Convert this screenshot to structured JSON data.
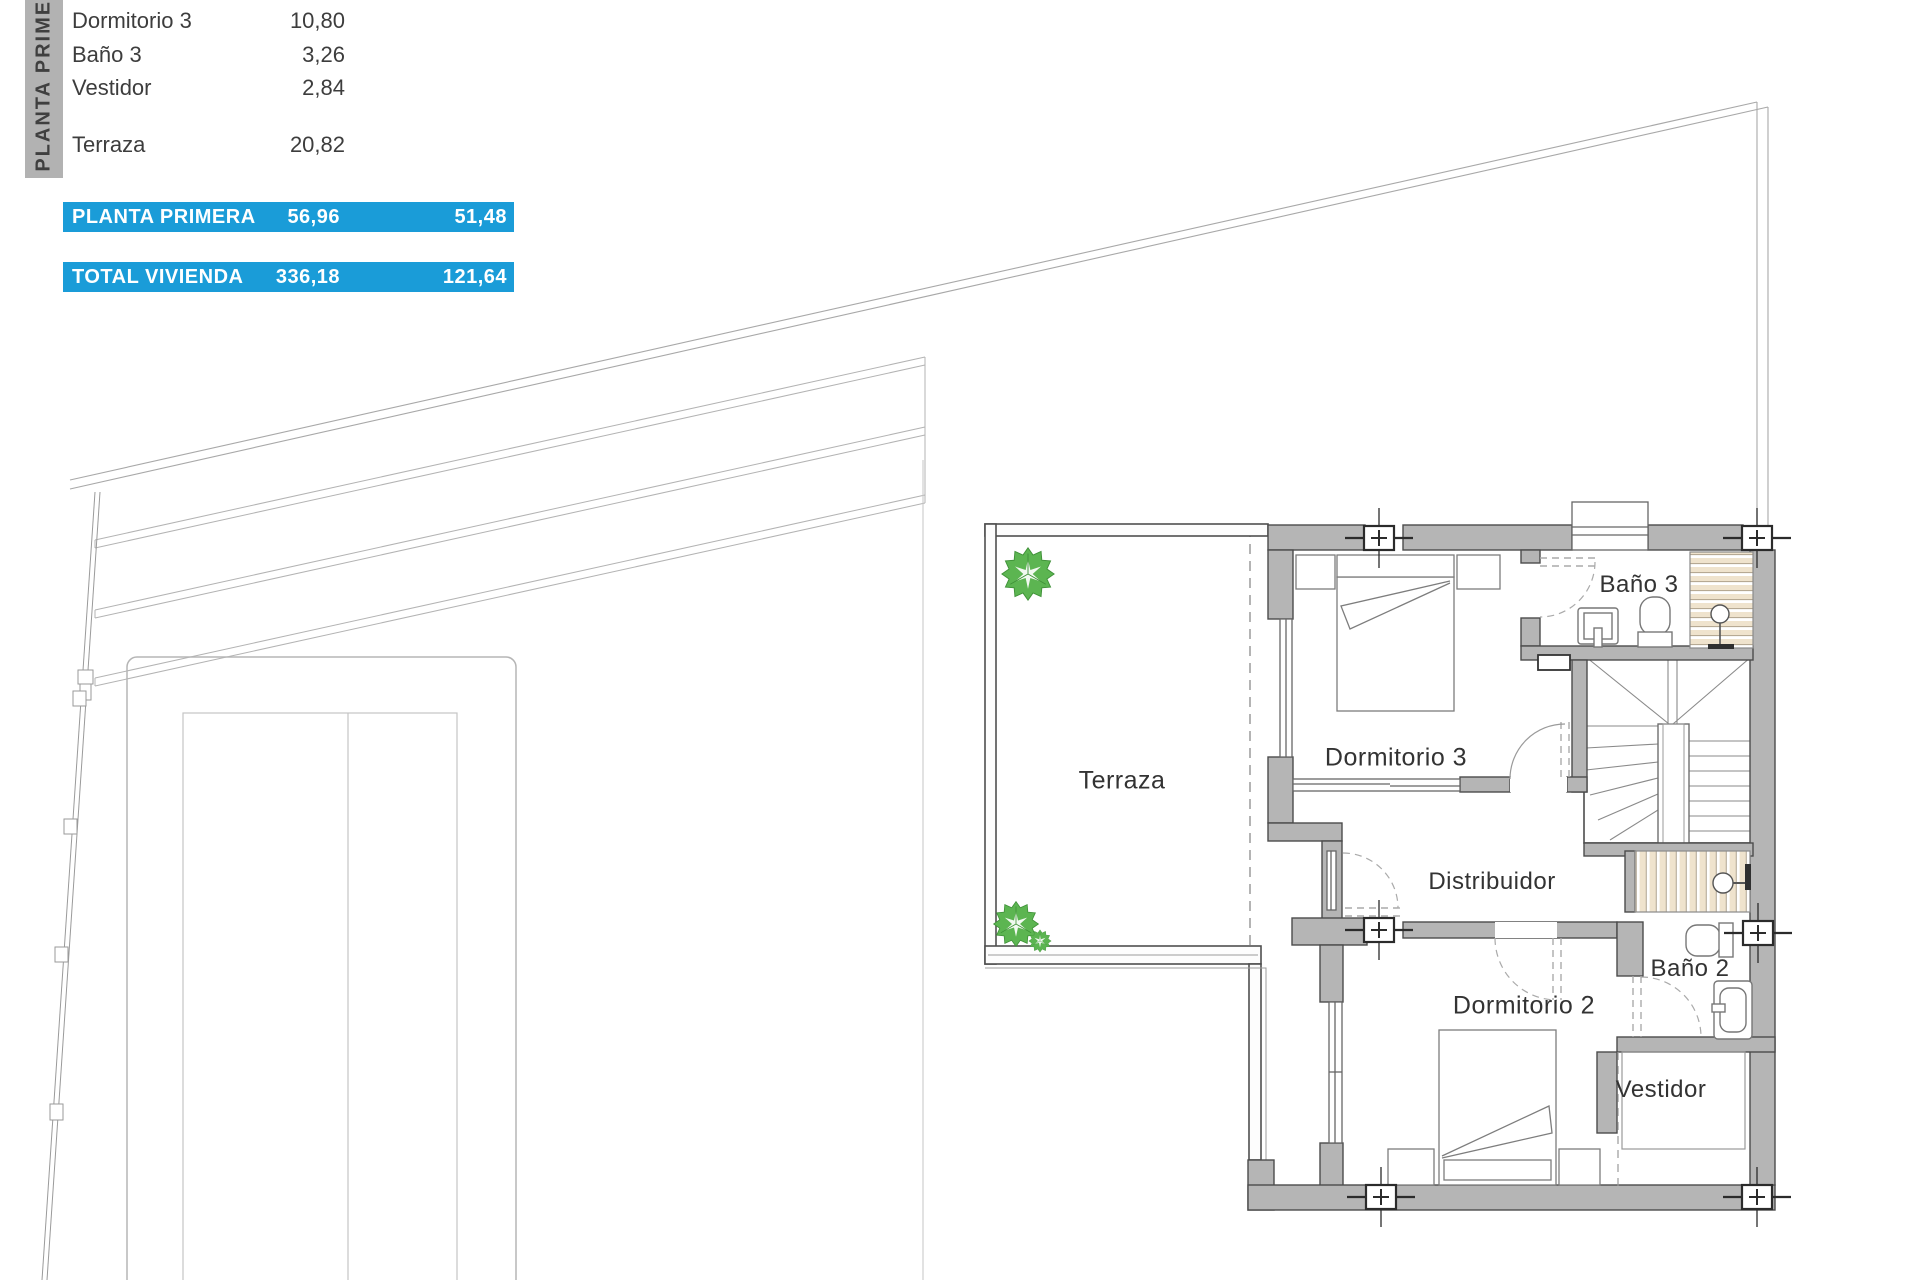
{
  "sidebar": {
    "label": "PLANTA PRIMERA"
  },
  "area_table": {
    "rows": [
      {
        "name": "Dormitorio 3",
        "value": "10,80"
      },
      {
        "name": "Baño 3",
        "value": "3,26"
      },
      {
        "name": "Vestidor",
        "value": "2,84"
      },
      {
        "name": "Terraza",
        "value": "20,82"
      }
    ],
    "summary": [
      {
        "name": "PLANTA PRIMERA",
        "value1": "56,96",
        "value2": "51,48"
      },
      {
        "name": "TOTAL VIVIENDA",
        "value1": "336,18",
        "value2": "121,64"
      }
    ]
  },
  "floorplan": {
    "rooms": {
      "terraza": "Terraza",
      "dormitorio3": "Dormitorio 3",
      "bano3": "Baño 3",
      "distribuidor": "Distribuidor",
      "dormitorio2": "Dormitorio 2",
      "bano2": "Baño 2",
      "vestidor": "Vestidor"
    }
  },
  "colors": {
    "accent_blue": "#1a9cd8",
    "wall_gray": "#b5b5b5",
    "shower_beige": "#efe3cd",
    "plant_green": "#5cb551"
  }
}
